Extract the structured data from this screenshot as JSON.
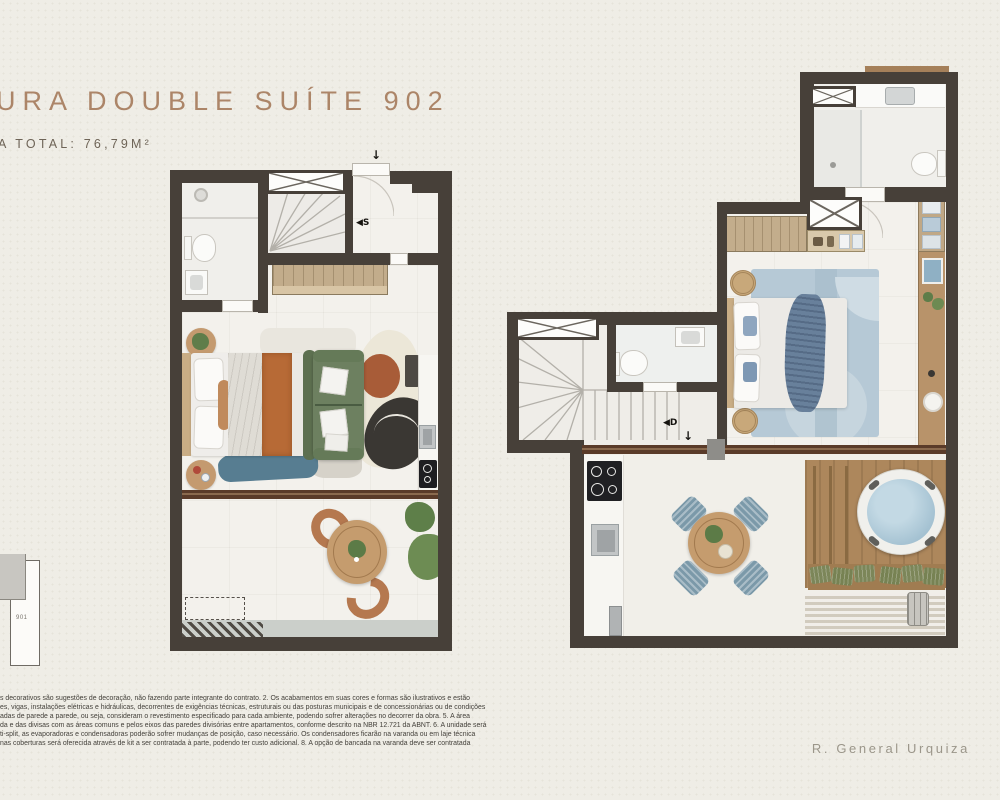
{
  "header": {
    "title": "URA DOUBLE SUÍTE 902",
    "area_total": "A TOTAL: 76,79M²"
  },
  "keyplan": {
    "unit": "901"
  },
  "plans": {
    "first_level": {
      "stair_direction_label": "◀S",
      "entry_arrow": "↓"
    },
    "second_level": {
      "stair_direction_label": "◀D",
      "entry_arrow": "↓"
    }
  },
  "footer": {
    "street": "R. General Urquiza"
  },
  "disclaimer": {
    "lines": [
      "s decorativos são sugestões de decoração, não fazendo parte integrante do contrato. 2. Os acabamentos em suas cores e formas são ilustrativos e estão",
      "es, vigas, instalações elétricas e hidráulicas, decorrentes de exigências técnicas, estruturais ou das posturas municipais e de concessionárias ou de condições",
      "adas de parede a parede, ou seja, consideram o revestimento especificado para cada ambiente, podendo sofrer alterações no decorrer da obra. 5. A área",
      "da e das divisas com as áreas comuns e pelos eixos das paredes divisórias entre apartamentos, conforme descrito na NBR 12.721 da ABNT. 6. A unidade será",
      "ti-split, as evaporadoras e condensadoras poderão sofrer mudanças de posição, caso necessário. Os condensadores ficarão na varanda ou em laje técnica",
      "nas coberturas será oferecida através de kit a ser contratada à parte, podendo ter custo adicional. 8. A opção de bancada na varanda deve ser contratada"
    ]
  },
  "colors": {
    "wall": "#474039",
    "title_accent": "#ac8568",
    "wood": "#b8936a",
    "track_brown": "#5a3b29",
    "sofa_green": "#6d8060",
    "rug_rust": "#a85c38",
    "rug_charcoal": "#3a3733",
    "rug_blue": "#b6c9d6",
    "spa_water": "#a6c3d3"
  }
}
